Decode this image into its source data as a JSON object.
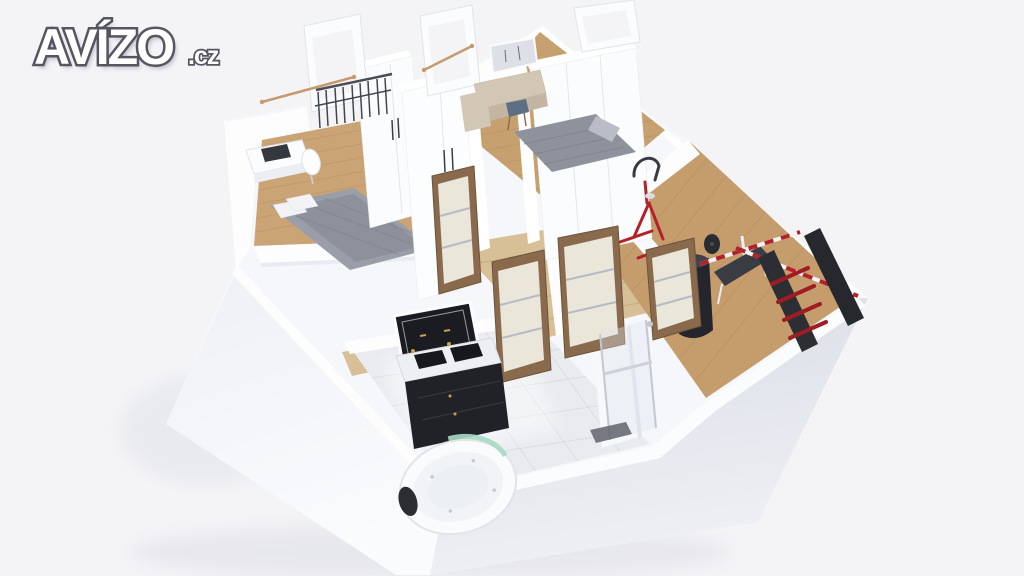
{
  "watermark": {
    "brand": "AVÍZO",
    "suffix": ".cz"
  },
  "scene": {
    "type": "3d-apartment-floor-plan-render",
    "rooms": [
      {
        "name": "bedroom-left",
        "objects": [
          "desk",
          "laptop",
          "white-chair",
          "double-bed",
          "wardrobe",
          "french-window-with-railing",
          "curtain-rod"
        ]
      },
      {
        "name": "bedroom-top",
        "objects": [
          "vanity-table",
          "vanity-mirror",
          "stool",
          "drawer-unit",
          "double-bed",
          "open-tilted-windows"
        ]
      },
      {
        "name": "home-gym",
        "objects": [
          "exercise-bike",
          "punching-bag",
          "weight-bench",
          "striped-barbell",
          "weight-plate",
          "weight-rack",
          "red-dumbbells"
        ]
      },
      {
        "name": "bathroom",
        "objects": [
          "led-mirror",
          "double-sink-vanity",
          "round-jacuzzi-tub",
          "headrest-pillow",
          "walk-in-shower",
          "towel-rail",
          "partition-wall",
          "floor-drain"
        ]
      },
      {
        "name": "hallway",
        "objects": [
          "interior-door",
          "interior-door",
          "interior-door",
          "interior-door"
        ]
      }
    ]
  },
  "colors": {
    "background": "#f4f4f7",
    "wall-bright": "#fdfdfe",
    "wall-light": "#f6f7fa",
    "wall-shade": "#e3e5ec",
    "face-top": "#dde0e8",
    "face-bottom": "#f0f1f6",
    "wood": "#cba476",
    "wood-2": "#c7a070",
    "wood-3": "#c59c6c",
    "wood-pale": "#d7bf97",
    "wood-dark": "#a9854f",
    "tile": "#e9ebef",
    "door-frame": "#8a6a4d",
    "door-panel": "#ebe6da",
    "metal": "#b6bac2",
    "red": "#b22228",
    "red-dark": "#9e1d23",
    "dark": "#26282d",
    "bed-gray": "#999ea9",
    "bed-gray-dark": "#7d818c",
    "pillow": "#f2f3f6",
    "marble": "#edeff3",
    "vanity-black": "#212227",
    "gold": "#c4a250",
    "glass-green": "#a6d9c3",
    "chrome": "#c6cad1",
    "stool-blue": "#5d6e85",
    "beige": "#d2c6b4",
    "copper": "#c69a6e",
    "logo-fill": "#ffffff",
    "logo-outline": "#55565f"
  }
}
